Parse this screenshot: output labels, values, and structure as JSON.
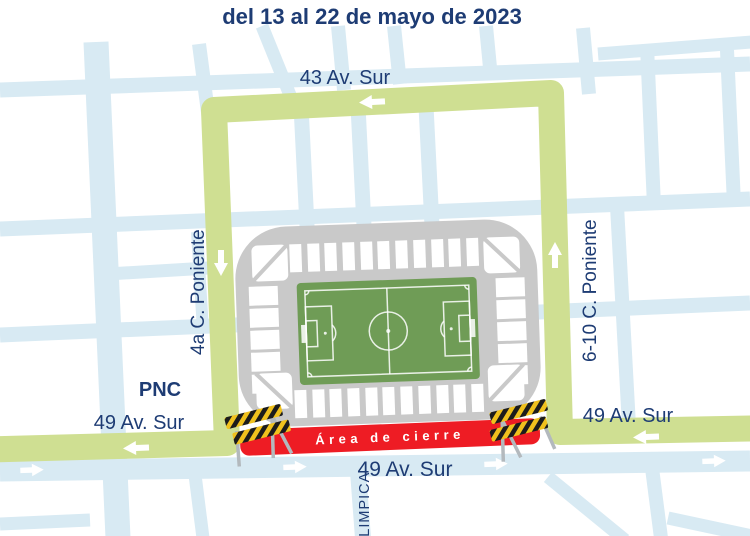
{
  "title": "del 13 al 22 de mayo de 2023",
  "labels": {
    "avenue_top": "43 Av. Sur",
    "street_left": "4a C. Poniente",
    "street_right": "6-10 C. Poniente",
    "pnc": "PNC",
    "avenue_49_left": "49 Av. Sur",
    "avenue_49_center": "49 Av. Sur",
    "avenue_49_right": "49 Av. Sur",
    "avenue_olimpica": "OLIMPICA",
    "closure_area": "Área de cierre"
  },
  "colors": {
    "text_navy": "#1e3c74",
    "route_green": "#cfdf92",
    "street_blue": "#d8eaf3",
    "closure_red": "#ee1c24",
    "stadium_gray": "#c9c9c9",
    "field_green": "#6f9c56",
    "barrier_yellow": "#f0c11d",
    "barrier_black": "#1c1c1c",
    "arrow_white": "#ffffff"
  }
}
